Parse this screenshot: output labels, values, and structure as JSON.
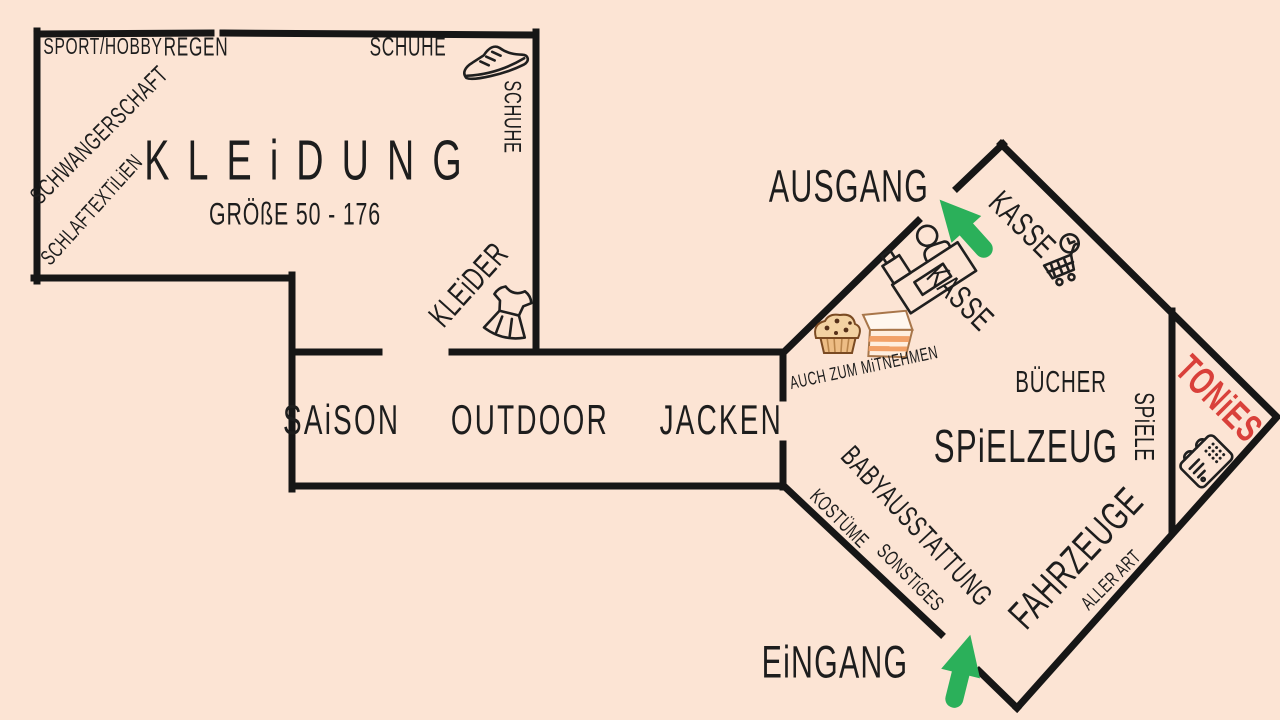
{
  "title": "Hand-drawn store floor plan",
  "colors": {
    "background": "#fce4d4",
    "wall": "#161616",
    "ink": "#1d1d1d",
    "tonies_red": "#d9403a",
    "arrow_green": "#2bb05a"
  },
  "kleidung_room": {
    "name": "KLEiDUNG",
    "size_range": "GRÖßE 50 - 176",
    "sections": {
      "sport_hobby": "SPORT/HOBBY",
      "regen": "REGEN",
      "schuhe": "SCHUHE",
      "schuhe_wall": "SCHUHE",
      "schwangerschaft": "SCHWANGERSCHAFT",
      "schlaftextilien": "SCHLAFTEXTiLiEN",
      "kleider": "KLEiDER"
    }
  },
  "corridor": {
    "label": "SAiSON  OUTDOOR  JACKEN"
  },
  "spielzeug_room": {
    "exit_label": "AUSGANG",
    "entrance_label": "EiNGANG",
    "kasse_counter": "KASSE",
    "kasse_checkout": "KASSE",
    "takeaway": "AUCH ZUM MiTNEHMEN",
    "sections": {
      "buecher": "BÜCHER",
      "spielzeug": "SPiELZEUG",
      "spiele": "SPiELE",
      "babyausstattung": "BABYAUSSTATTUNG",
      "kostueme": "KOSTÜME",
      "sonstiges": "SONSTiGES",
      "fahrzeuge": "FAHRZEUGE",
      "fahrzeuge_sub": "ALLER ART"
    }
  },
  "tonies_corner": {
    "label": "TONiES"
  },
  "icons": {
    "sneaker": "sneaker-shoes",
    "dress": "dress",
    "register": "cash-register-with-cashier",
    "cart_clock": "shopping-cart-with-clock",
    "muffin": "chocolate-chip-muffin",
    "cake": "cake-slice",
    "toniebox": "toniebox-speaker",
    "exit_arrow": "green-arrow-up-left",
    "entrance_arrow": "green-arrow-up"
  }
}
